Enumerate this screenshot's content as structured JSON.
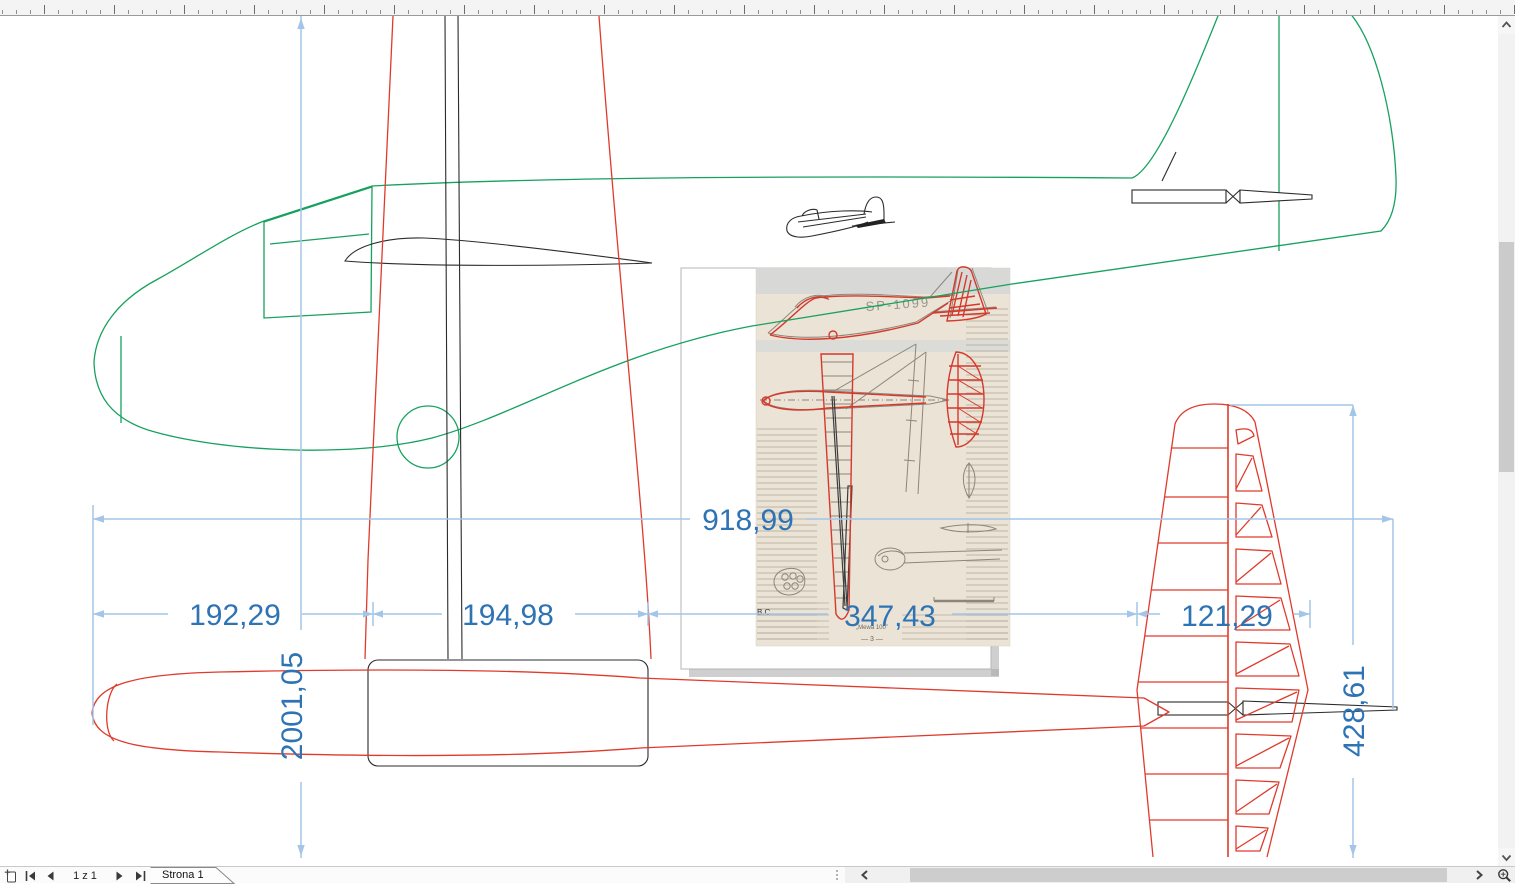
{
  "window": {
    "page_indicator": "1 z 1",
    "page_tab_label": "Strona 1"
  },
  "dimensions": {
    "width_total": "918,99",
    "seg_left": "192,29",
    "seg_mid": "194,98",
    "seg_right": "347,43",
    "seg_tail": "121,29",
    "length_total": "2001,05",
    "tail_height": "428,61"
  },
  "scan": {
    "registration": "SP-1099",
    "caption": "„Mewa 100”",
    "page_number": "— 3 —",
    "margin_note": "B.C"
  },
  "colors": {
    "dimension_text": "#2e73b4",
    "dimension_line": "#a3c5e8",
    "outline_green": "#17a15e",
    "outline_red": "#e03a2c",
    "scan_red": "#d6392c",
    "scan_gray": "#8d867a",
    "scan_bg": "#eae3d6"
  }
}
